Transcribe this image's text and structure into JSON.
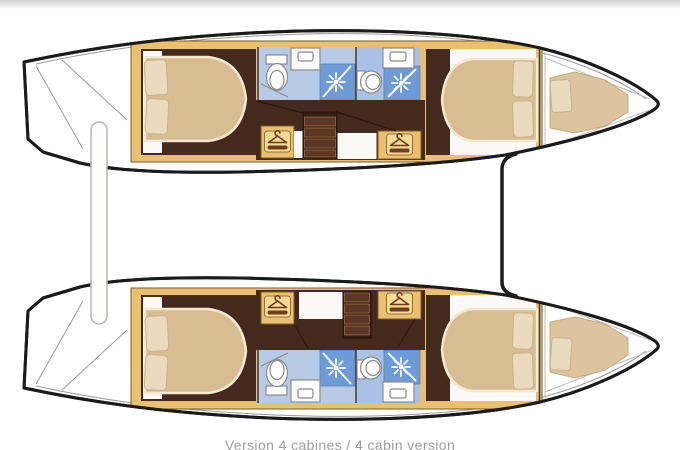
{
  "caption": "Version 4 cabines / 4 cabin version",
  "diagram": {
    "type": "boat-floor-plan",
    "subject": "catamaran top-view layout, 4 cabin version",
    "hulls": [
      {
        "name": "port-hull",
        "position": "top",
        "rooms": [
          "aft-double-cabin",
          "aft-bathroom-with-shower",
          "companionway-steps",
          "wardrobe",
          "wardrobe",
          "forward-bathroom-with-shower",
          "forward-double-cabin",
          "bow-berth"
        ]
      },
      {
        "name": "starboard-hull",
        "position": "bottom",
        "rooms": [
          "aft-double-cabin",
          "aft-bathroom-with-shower",
          "companionway-steps",
          "wardrobe",
          "wardrobe",
          "forward-bathroom-with-shower",
          "forward-double-cabin",
          "bow-berth"
        ]
      }
    ],
    "icons": {
      "hanger-icon": "wardrobe / hanging locker",
      "shower-icon": "shower head starburst",
      "toilet-icon": "marine toilet",
      "sink-icon": "washbasin counter"
    }
  },
  "colors": {
    "outline": "#1b1b1b",
    "deck_line": "#9a9a9a",
    "cabinet_yellow": "#eac06e",
    "cabinet_yellow_light": "#f5d994",
    "cabinet_border": "#7a5a2a",
    "wood_brown": "#44291d",
    "steps_dark": "#311c12",
    "step_tread": "#5d3726",
    "step_edge": "#9c6b45",
    "bed_tan": "#d8bd92",
    "bed_edge": "#f3e9d2",
    "pillow": "#eadbbe",
    "pillow_edge": "#c8b48c",
    "bow_cushion": "#dbc49e",
    "bath_blue": "#b7cbe7",
    "bath_blue2": "#a9c1e4",
    "shower_blue": "#6e9ad6",
    "fixture_white": "#fcfcfb",
    "fixture_line": "#8c8c8c",
    "floor_white": "#faf9f6",
    "hanger_brown": "#6b3e1f",
    "caption_gray": "#9e9e9e",
    "top_shade": "#d2d2d2"
  }
}
